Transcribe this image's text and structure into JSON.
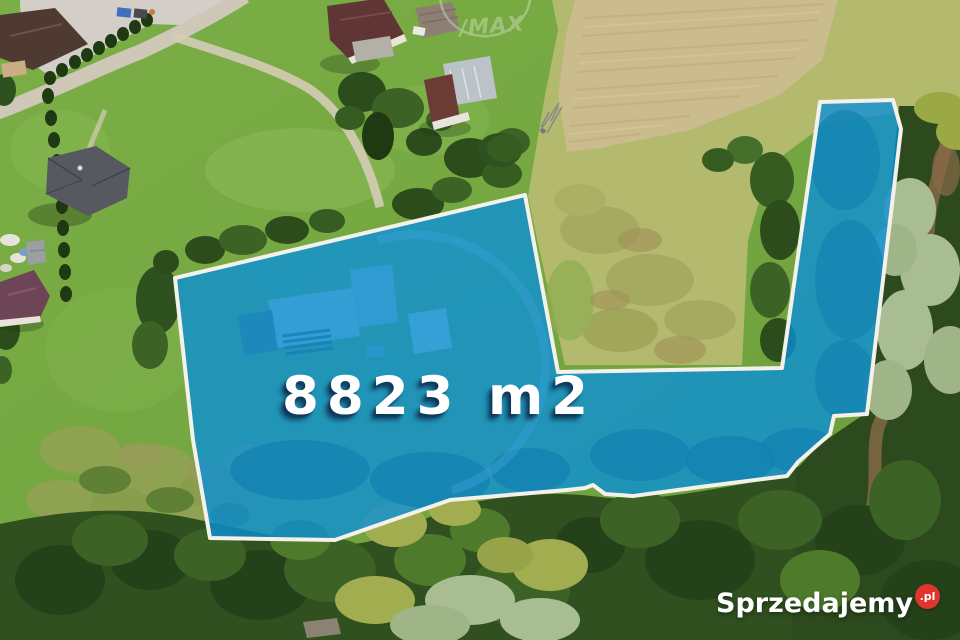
{
  "plot": {
    "area_label": "8823 m2",
    "fill_color": "#0a90d8",
    "border_color": "#f4f1ea"
  },
  "watermarks": {
    "site_name": "Sprzedajemy",
    "site_suffix": ".pl",
    "site_suffix_bg": "#e0352c",
    "agency_text": "/MAX"
  }
}
